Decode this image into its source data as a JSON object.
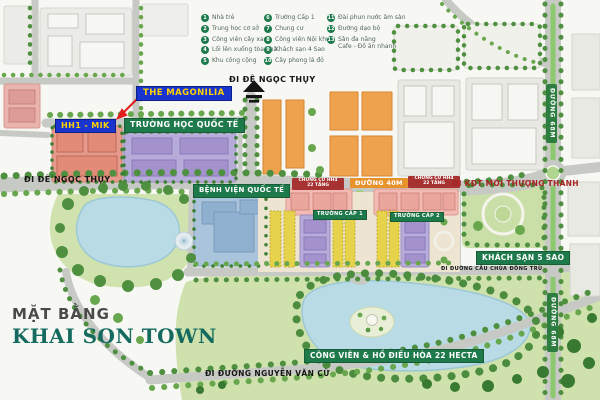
{
  "legend": {
    "items": [
      {
        "num": "1",
        "label": "Nhà trẻ"
      },
      {
        "num": "2",
        "label": "Trung học cơ sở"
      },
      {
        "num": "3",
        "label": "Công viên cây xanh"
      },
      {
        "num": "4",
        "label": "Lối lên xuống tòa nhà"
      },
      {
        "num": "5",
        "label": "Khu công cộng"
      },
      {
        "num": "6",
        "label": "Trường Cấp 1"
      },
      {
        "num": "7",
        "label": "Chung cư"
      },
      {
        "num": "8",
        "label": "Công viên Nội khu"
      },
      {
        "num": "9",
        "label": "Khách sạn 4 Sao"
      },
      {
        "num": "10",
        "label": "Cây phong lá đỏ"
      },
      {
        "num": "11",
        "label": "Đài phun nước âm sàn"
      },
      {
        "num": "12",
        "label": "Đường dạo bộ"
      },
      {
        "num": "13",
        "label": "Sân đa năng",
        "label2": "Cafe - Đồ ăn nhanh"
      }
    ]
  },
  "labels": {
    "the_magonilia": "THE MAGONILIA",
    "hh1_mik": "HH1 - MIK",
    "truong_hoc_quoc_te": "TRƯỜNG HỌC QUỐC TẾ",
    "di_de_ngoc_thuy": "ĐI ĐÊ NGỌC THỤY",
    "benh_vien_quoc_te": "BỆNH VIỆN QUỐC TẾ",
    "chung_cu_hh4_line1": "CHUNG CƯ HH4",
    "chung_cu_hh4_line2": "22 TẦNG",
    "duong_40m": "ĐƯỜNG 40M",
    "di_kdt_moi_thuong_thanh": "ĐI KĐT MỚI THƯỢNG THANH",
    "truong_cap_1": "TRƯỜNG CẤP 1",
    "truong_cap_2": "TRƯỜNG CẤP 2",
    "khach_san_5_sao": "KHÁCH SẠN 5 SAO",
    "di_duong_cau_chua_dong_tru": "ĐI ĐƯỜNG CẦU CHÙA ĐÔNG TRÙ",
    "cong_vien_ho_dieu_hoa": "CÔNG VIÊN & HỒ ĐIỀU HÒA 22 HECTA",
    "di_duong_nguyen_van_cu": "ĐI ĐƯỜNG NGUYỄN VĂN CỪ",
    "duong_68m": "ĐƯỜNG 68M"
  },
  "title": {
    "line1": "MẶT BẰNG",
    "line2": "KHAI SON TOWN"
  },
  "colors": {
    "blue_label_bg": "#1a35cf",
    "blue_label_text": "#ffd400",
    "green_label_bg": "#1e7a4b",
    "orange_label_bg": "#e8922c",
    "darkred_label_bg": "#a63232",
    "red_road_text": "#a82222",
    "title_teal": "#156a5f",
    "legend_green": "#1d7a4c",
    "lake": "#b9dbe6",
    "park": "#cfe2ae",
    "road": "#c7c9c4",
    "condo_orange": "#efa24e",
    "condo_pink": "#f2bab2",
    "school_purple": "#b7abd9",
    "hospital_blue": "#a9c4db",
    "shophouse_yellow": "#e7d24b",
    "hh1_salmon": "#e59a8b"
  }
}
